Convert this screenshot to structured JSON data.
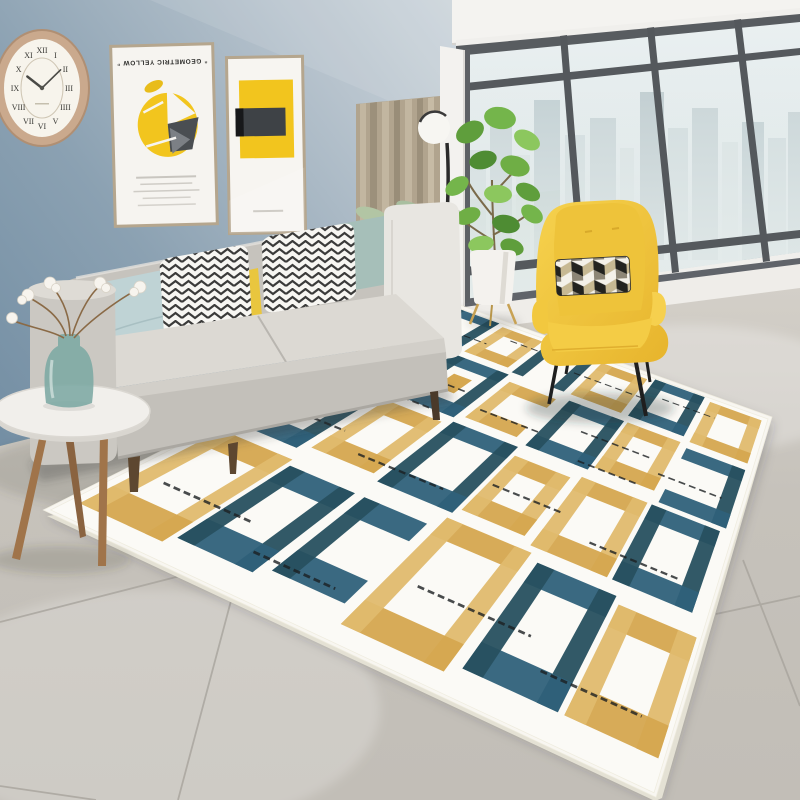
{
  "scene": {
    "description": "Bright modern living room staging a brushstroke geometric area rug",
    "room": {
      "wall": "slate blue painted wall",
      "floor": "large grey ceramic tiles",
      "view": "hazy city skyline through floor-to-ceiling black framed windows"
    }
  },
  "wall_clock": {
    "numerals": [
      "XII",
      "I",
      "II",
      "III",
      "IIII",
      "V",
      "VI",
      "VII",
      "VIII",
      "IX",
      "X",
      "XI"
    ],
    "time_shown": "10:09"
  },
  "posters": {
    "large": {
      "title": "“ GEOMETRIC YELLOW ”",
      "printed_rotation_deg": 180
    },
    "small": {
      "subject": "yellow square with charcoal block"
    }
  },
  "furnishings": [
    "wooden wall clock",
    "two framed geometric posters",
    "grey fabric sofa with throw pillows",
    "round tray side table with glass vase and cotton stems",
    "black globe floor lamp",
    "potted fiddle-leaf fig",
    "yellow wingback armchair with cube-pattern cushion",
    "teal and gold brushstroke squares area rug"
  ],
  "palette": {
    "wall_blue": "#7f96a9",
    "wall_blue_light": "#bcc8d1",
    "curtain_beige": "#b1a48e",
    "sofa_grey": "#c7c4be",
    "pillow_mint": "#bfd3d5",
    "pillow_yellow": "#e9c63e",
    "pillow_sage": "#a6bfb9",
    "zigzag_ink": "#262626",
    "armchair_yellow": "#f0c434",
    "rug_teal": "#2f617a",
    "rug_teal_dark": "#27505f",
    "rug_gold": "#d5a74f",
    "rug_gold_light": "#e0ba6e",
    "rug_ground": "#fbfaf6",
    "rug_ink": "#1b1f22",
    "floor_grey": "#c6c2bb",
    "window_frame_grey": "#55595d",
    "city_haze": "#dfe8ea",
    "plant_green": "#6fae45",
    "wood_tan": "#a0744a"
  }
}
